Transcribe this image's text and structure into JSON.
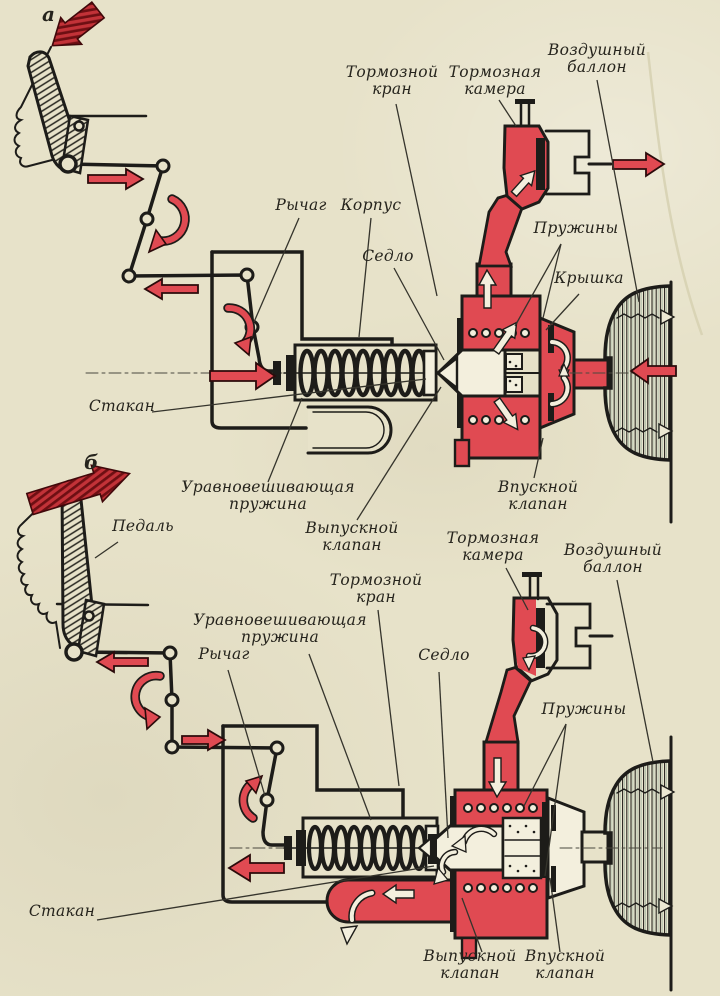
{
  "figure": {
    "description": "Pneumatic brake system schematic in two states",
    "colors": {
      "paper": "#e7e2c9",
      "pressure_red": "#e04a52",
      "dark_red_arrow": "#8d1d22",
      "ink": "#1d1c19"
    }
  },
  "diagram_top": {
    "letter": "а",
    "labels": {
      "brake_valve": "Тормозной\nкран",
      "brake_chamber": "Тормозная\nкамера",
      "air_tank": "Воздушный\nбаллон",
      "lever": "Рычаг",
      "housing": "Корпус",
      "seat": "Седло",
      "springs": "Пружины",
      "cover": "Крышка",
      "cup": "Стакан",
      "balance_spring": "Уравновешивающая\nпружина",
      "exhaust_valve": "Выпускной\nклапан",
      "intake_valve": "Впускной\nклапан"
    }
  },
  "diagram_bottom": {
    "letter": "б",
    "labels": {
      "pedal": "Педаль",
      "balance_spring": "Уравновешивающая\nпружина",
      "lever": "Рычаг",
      "brake_valve": "Тормозной\nкран",
      "seat": "Седло",
      "brake_chamber": "Тормозная\nкамера",
      "air_tank": "Воздушный\nбаллон",
      "springs": "Пружины",
      "cup": "Стакан",
      "exhaust_valve": "Выпускной\nклапан",
      "intake_valve": "Впускной\nклапан"
    }
  }
}
